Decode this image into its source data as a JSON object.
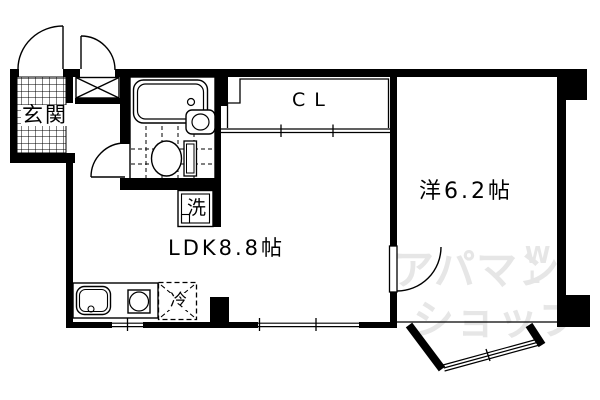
{
  "plan": {
    "entrance_label": "玄関",
    "closet_label": "CL",
    "washer_label": "洗",
    "ldk_label": "LDK8.8帖",
    "western_room_label": "洋6.2帖",
    "fridge_label": "冷"
  },
  "watermark": {
    "line1": "アパマン",
    "line2": "ショップ",
    "mark_top": "W",
    "mark_bottom": "L"
  },
  "colors": {
    "wall": "#000000",
    "line": "#000000",
    "background": "#ffffff",
    "watermark": "#e6e6e6"
  }
}
